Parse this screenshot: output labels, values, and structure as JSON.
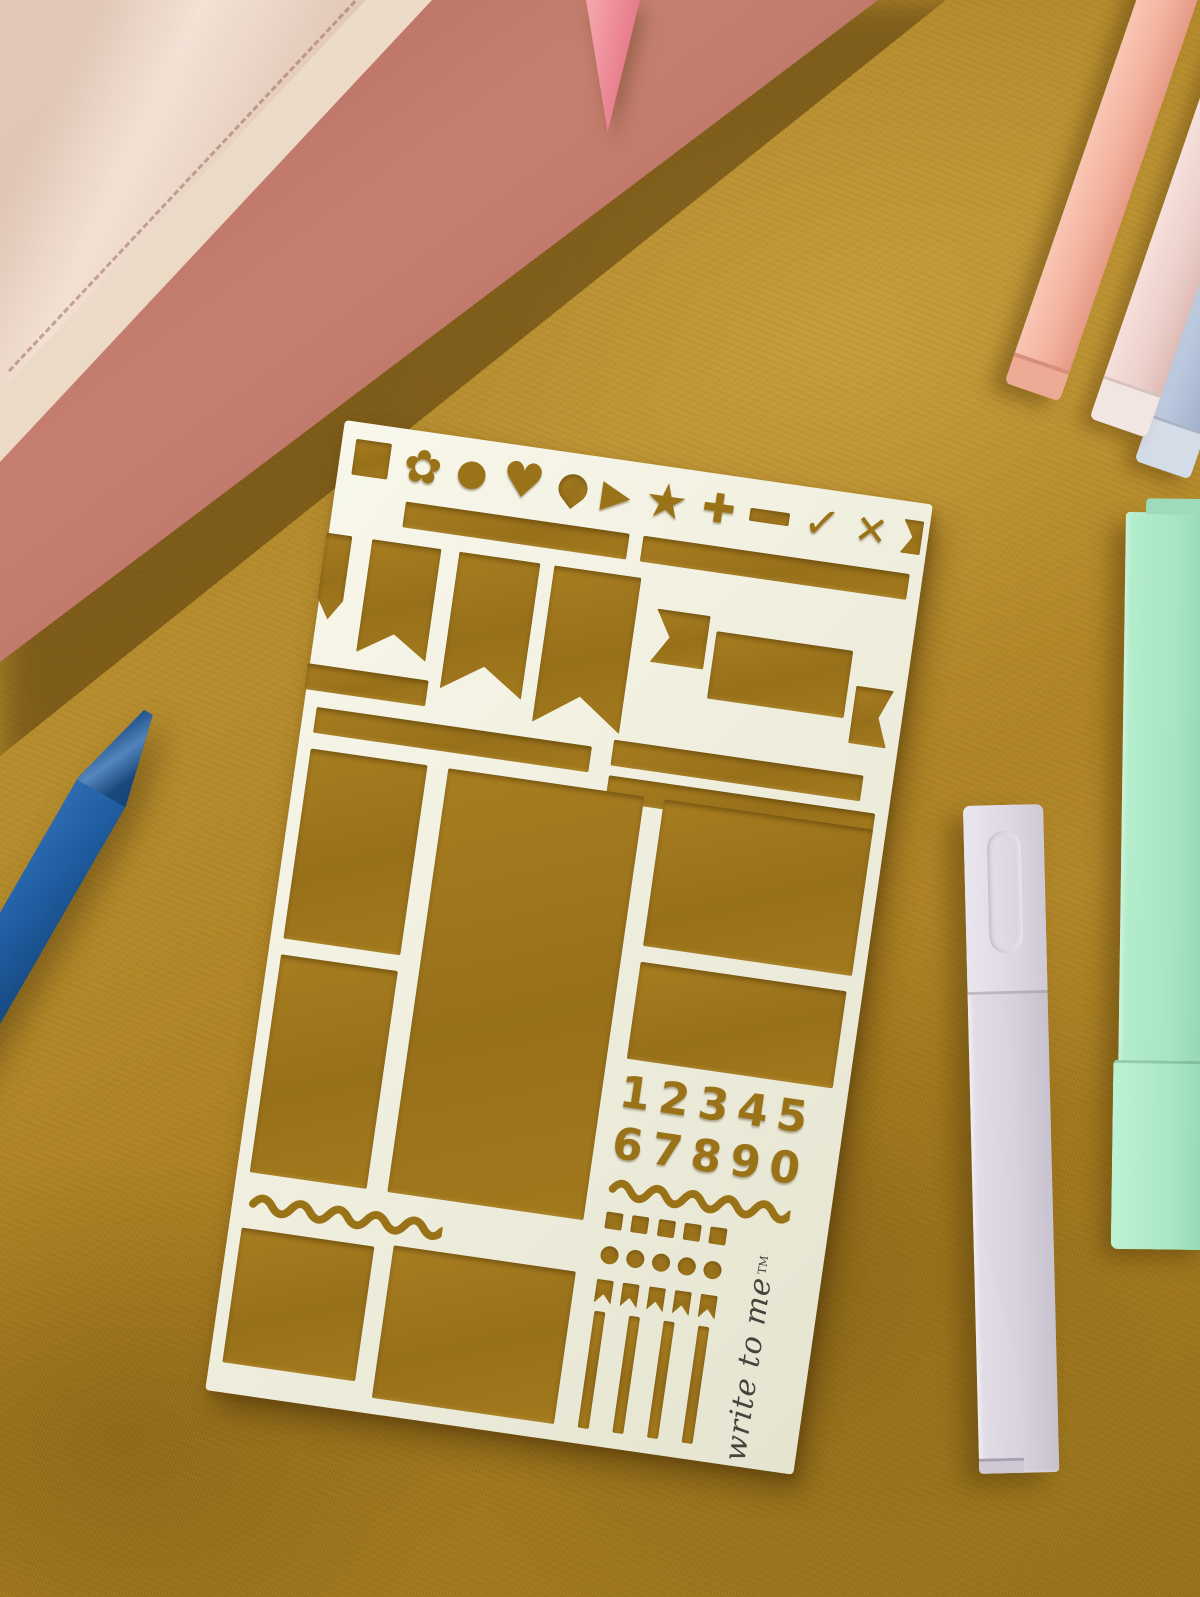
{
  "scene": {
    "description": "Flat-lay photo of a cream journaling stencil on mustard velvet fabric with notebooks, pens and pastel markers",
    "fabric": {
      "name": "mustard-velvet-fabric",
      "base_color": "#ab7f20",
      "highlight_color": "#c79b3e",
      "shadow_color": "#8d6814"
    },
    "stencil": {
      "name": "journaling-layout-stencil",
      "material_color": "#f0efdf",
      "cutout_color": "#9a7318",
      "rotation_deg": 8.2,
      "numbers_row_1": "12345",
      "numbers_row_2": "67890",
      "brand": {
        "text": "write to me",
        "trademark": "TM"
      },
      "shape_icons": [
        {
          "name": "square-icon",
          "glyph": ""
        },
        {
          "name": "flower-icon",
          "glyph": "✿"
        },
        {
          "name": "circle-icon",
          "glyph": "●"
        },
        {
          "name": "heart-icon",
          "glyph": "♥"
        },
        {
          "name": "balloon-pin-icon",
          "glyph": ""
        },
        {
          "name": "play-triangle-icon",
          "glyph": "▶"
        },
        {
          "name": "star-icon",
          "glyph": "★"
        },
        {
          "name": "plus-icon",
          "glyph": "✚"
        },
        {
          "name": "minus-icon",
          "glyph": ""
        },
        {
          "name": "check-icon",
          "glyph": "✓"
        },
        {
          "name": "cross-icon",
          "glyph": "✕"
        },
        {
          "name": "flag-end-icon",
          "glyph": ""
        }
      ]
    },
    "objects": [
      {
        "name": "blush-notebook",
        "color": "#ecd1c0"
      },
      {
        "name": "rose-notebook",
        "color": "#b66a5c"
      },
      {
        "name": "pink-pen-tip",
        "color": "#ea8492"
      },
      {
        "name": "blue-pen",
        "color": "#2160a6"
      },
      {
        "name": "peach-marker",
        "color": "#f2b19d"
      },
      {
        "name": "pink-marker",
        "color": "#eccfca"
      },
      {
        "name": "periwinkle-marker",
        "color": "#aebbd5"
      },
      {
        "name": "mint-marker",
        "color": "#a7e5c2"
      },
      {
        "name": "lilac-marker",
        "color": "#d7d2dd"
      }
    ]
  }
}
